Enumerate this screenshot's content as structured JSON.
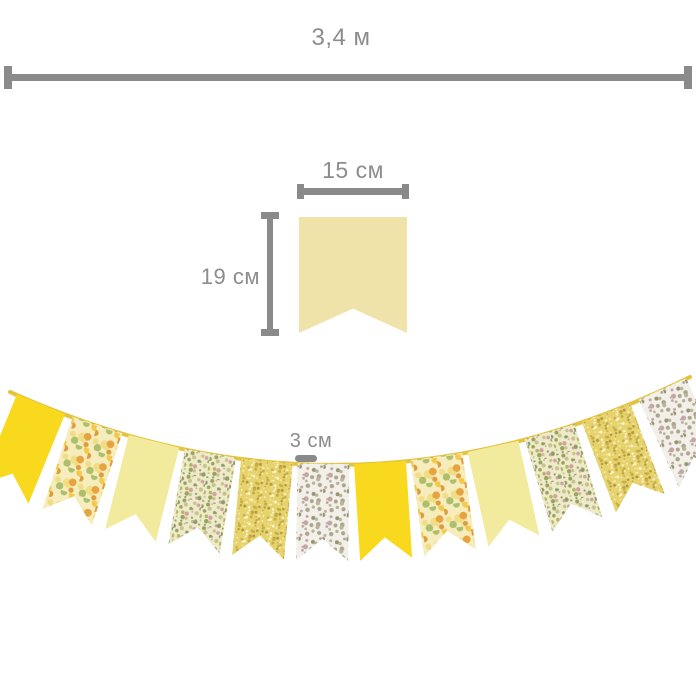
{
  "measurements": {
    "total_length": {
      "label": "3,4 м"
    },
    "flag_width": {
      "label": "15 см"
    },
    "flag_height": {
      "label": "19 см"
    },
    "flag_gap": {
      "label": "3 см"
    }
  },
  "colors": {
    "dimension_line": "#8a8a8a",
    "dimension_text": "#8c8c8c",
    "single_flag": "#efe3a9",
    "string": "#e6c33d"
  },
  "garland": {
    "flag_count": 12,
    "pattern_sequence": [
      "solid-yellow",
      "floral-yellow",
      "pale-yellow",
      "ditsy-floral",
      "speckle-yellow",
      "white-floral",
      "solid-yellow",
      "floral-yellow",
      "pale-yellow",
      "ditsy-floral",
      "speckle-yellow",
      "white-floral"
    ],
    "patterns": {
      "solid-yellow": {
        "base": "#f8d91e"
      },
      "floral-yellow": {
        "base": "#f6ecbc",
        "dots": [
          "#f2c94a",
          "#e6a440",
          "#abbf6c",
          "#f2dd85",
          "#dd9c3e",
          "#ffffff"
        ],
        "step": 8,
        "r": 2.8,
        "seed": 11
      },
      "pale-yellow": {
        "base": "#f2eb9e"
      },
      "ditsy-floral": {
        "base": "#edebca",
        "dots": [
          "#9aa35d",
          "#d2a2a1",
          "#b7b464",
          "#8d9d67",
          "#c9c28e",
          "#dfaea7"
        ],
        "step": 5,
        "r": 1.5,
        "seed": 23
      },
      "speckle-yellow": {
        "base": "#e7d36e",
        "dots": [
          "#f5ecb3",
          "#c7ad45",
          "#fdf6d7",
          "#b39a3c"
        ],
        "step": 4,
        "r": 1.1,
        "seed": 37
      },
      "white-floral": {
        "base": "#f2f0e9",
        "dots": [
          "#aca68e",
          "#c2a7a5",
          "#96966e",
          "#b8b399",
          "#d7cec3"
        ],
        "step": 6,
        "r": 1.8,
        "seed": 51
      }
    }
  }
}
